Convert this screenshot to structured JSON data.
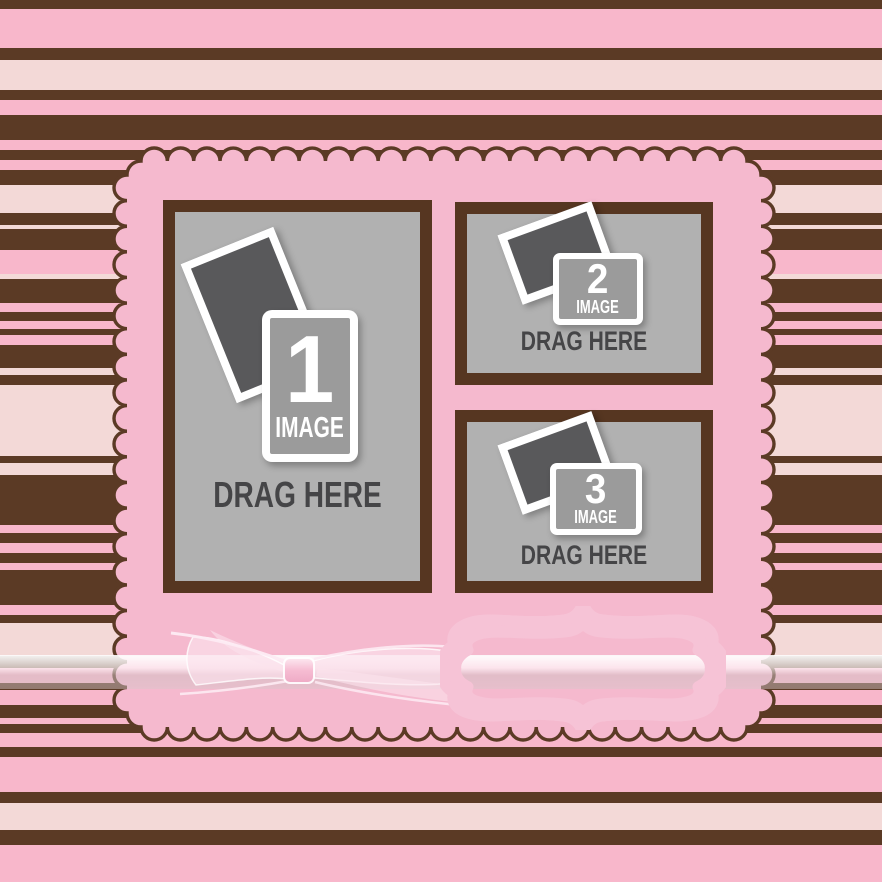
{
  "template": {
    "name": "photo-collage-template",
    "slots": [
      {
        "number": "1",
        "image_label": "IMAGE",
        "drag_label": "DRAG HERE"
      },
      {
        "number": "2",
        "image_label": "IMAGE",
        "drag_label": "DRAG HERE"
      },
      {
        "number": "3",
        "image_label": "IMAGE",
        "drag_label": "DRAG HERE"
      }
    ]
  },
  "colors": {
    "stripe_brown": "#5b3a25",
    "stripe_pink": "#f8b7cb",
    "stripe_pale_pink": "#f3d9d7",
    "card_pink": "#f5b9ce",
    "frame_border_brown": "#563621",
    "frame_gray": "#b1b1b1",
    "photo_front_gray": "#9b9b9b",
    "photo_back_gray": "#59595b",
    "placeholder_text_gray": "#454547",
    "plaque_white": "#fdfdfa",
    "plaque_halo_pink": "#f6c3d6",
    "ribbon_pink": "#f8c4d6"
  }
}
